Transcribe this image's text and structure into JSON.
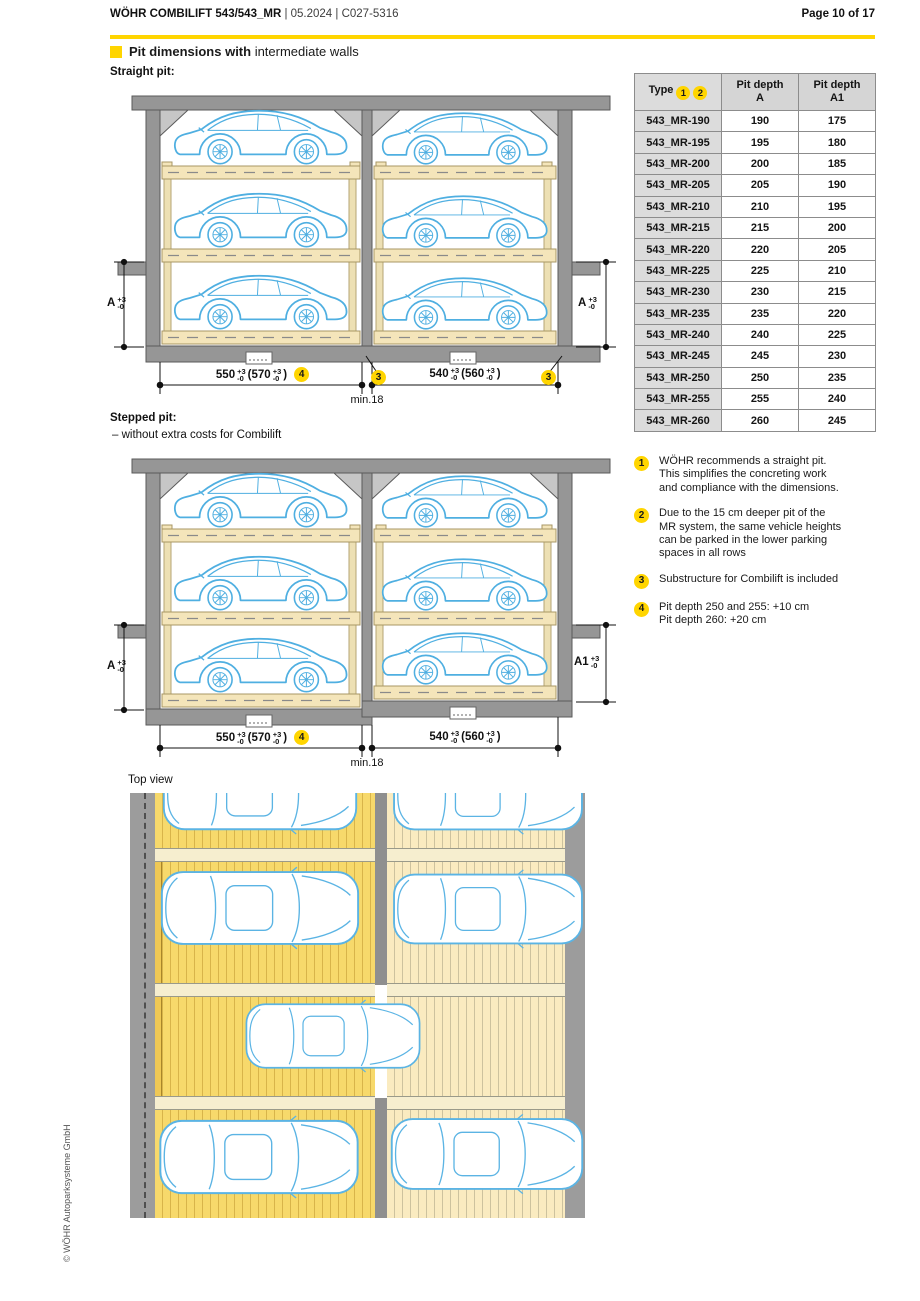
{
  "header": {
    "title_bold": "WÖHR COMBILIFT 543/543_MR",
    "title_meta": " | 05.2024 | C027-5316",
    "page": "Page 10 of 17"
  },
  "section": {
    "title_bold1": "Pit dimensions ",
    "title_bold2": "with",
    "title_rest": " intermediate walls"
  },
  "straight": {
    "label": "Straight pit:",
    "dim_left": {
      "main": "A",
      "plus": "+3",
      "minus": "-0"
    },
    "dim_right": {
      "main": "A",
      "plus": "+3",
      "minus": "-0"
    },
    "dim_bottom_left": {
      "main": "550",
      "plus": "+3",
      "minus": "-0",
      "paren": "(570",
      "paren_plus": "+3",
      "paren_minus": "-0",
      "close": ")"
    },
    "dim_bottom_right": {
      "main": "540",
      "plus": "+3",
      "minus": "-0",
      "paren": "(560",
      "paren_plus": "+3",
      "paren_minus": "-0",
      "close": ")"
    },
    "min_wall": "min.18",
    "callout_3": "3",
    "callout_4": "4"
  },
  "stepped": {
    "label": "Stepped pit:",
    "sublabel": "– without extra costs for Combilift",
    "dim_left": {
      "main": "A",
      "plus": "+3",
      "minus": "-0"
    },
    "dim_right": {
      "main": "A1",
      "plus": "+3",
      "minus": "-0"
    },
    "dim_bottom_left": {
      "main": "550",
      "plus": "+3",
      "minus": "-0",
      "paren": "(570",
      "paren_plus": "+3",
      "paren_minus": "-0",
      "close": ")"
    },
    "dim_bottom_right": {
      "main": "540",
      "plus": "+3",
      "minus": "-0",
      "paren": "(560",
      "paren_plus": "+3",
      "paren_minus": "-0",
      "close": ")"
    },
    "min_wall": "min.18",
    "callout_4": "4"
  },
  "top_view": {
    "label": "Top view"
  },
  "table": {
    "header_type": "Type",
    "header_callout_1": "1",
    "header_callout_2": "2",
    "header_a_1": "Pit depth",
    "header_a_2": "A",
    "header_a1_1": "Pit depth",
    "header_a1_2": "A1",
    "rows": [
      {
        "type": "543_MR-190",
        "a": "190",
        "a1": "175"
      },
      {
        "type": "543_MR-195",
        "a": "195",
        "a1": "180"
      },
      {
        "type": "543_MR-200",
        "a": "200",
        "a1": "185"
      },
      {
        "type": "543_MR-205",
        "a": "205",
        "a1": "190"
      },
      {
        "type": "543_MR-210",
        "a": "210",
        "a1": "195"
      },
      {
        "type": "543_MR-215",
        "a": "215",
        "a1": "200"
      },
      {
        "type": "543_MR-220",
        "a": "220",
        "a1": "205"
      },
      {
        "type": "543_MR-225",
        "a": "225",
        "a1": "210"
      },
      {
        "type": "543_MR-230",
        "a": "230",
        "a1": "215"
      },
      {
        "type": "543_MR-235",
        "a": "235",
        "a1": "220"
      },
      {
        "type": "543_MR-240",
        "a": "240",
        "a1": "225"
      },
      {
        "type": "543_MR-245",
        "a": "245",
        "a1": "230"
      },
      {
        "type": "543_MR-250",
        "a": "250",
        "a1": "235"
      },
      {
        "type": "543_MR-255",
        "a": "255",
        "a1": "240"
      },
      {
        "type": "543_MR-260",
        "a": "260",
        "a1": "245"
      }
    ]
  },
  "notes": [
    {
      "num": "1",
      "lines": [
        "WÖHR recommends a straight pit.",
        "This simplifies the concreting work",
        "and compliance with the dimensions."
      ]
    },
    {
      "num": "2",
      "lines": [
        "Due to the 15 cm deeper pit of the",
        "MR system, the same vehicle heights",
        "can be parked in the lower parking",
        "spaces in all rows"
      ]
    },
    {
      "num": "3",
      "lines": [
        "Substructure for Combilift is included"
      ]
    },
    {
      "num": "4",
      "lines": [
        "Pit depth 250 and 255: +10 cm",
        "Pit depth 260: +20 cm"
      ]
    }
  ],
  "footer": {
    "copyright": "© WÖHR Autoparksysteme GmbH"
  },
  "colors": {
    "brand_yellow": "#FFD500",
    "car_blue": "#4FAFE1",
    "wall_gray": "#969696",
    "platform_tan": "#F4E5BA",
    "topview_left_yellow": "#F7D96B",
    "topview_right_cream": "#FAEBC0"
  }
}
